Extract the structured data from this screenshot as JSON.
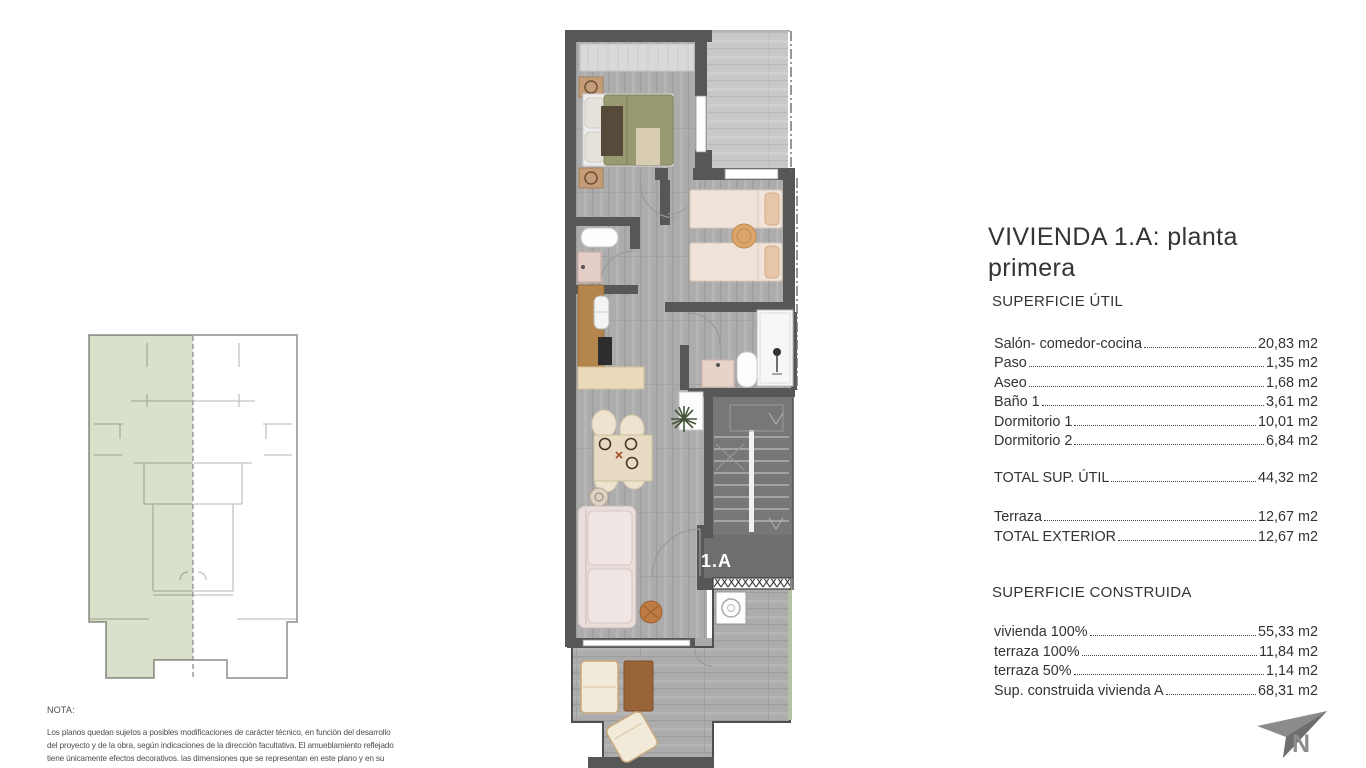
{
  "title": "VIVIENDA 1.A: planta primera",
  "plan": {
    "unit_label": "1.A"
  },
  "compass": {
    "label": "N"
  },
  "sections": {
    "util": {
      "heading": "SUPERFICIE ÚTIL",
      "rows": [
        {
          "label": "Salón- comedor-cocina",
          "value": "20,83 m2"
        },
        {
          "label": "Paso",
          "value": "1,35 m2"
        },
        {
          "label": "Aseo",
          "value": "1,68 m2"
        },
        {
          "label": "Baño 1",
          "value": "3,61 m2"
        },
        {
          "label": "Dormitorio 1",
          "value": "10,01 m2"
        },
        {
          "label": "Dormitorio 2",
          "value": "6,84 m2"
        }
      ],
      "total": {
        "label": "TOTAL SUP. ÚTIL",
        "value": "44,32 m2"
      }
    },
    "exterior": {
      "rows": [
        {
          "label": "Terraza",
          "value": "12,67 m2"
        }
      ],
      "total": {
        "label": "TOTAL EXTERIOR",
        "value": "12,67 m2"
      }
    },
    "construida": {
      "heading": "SUPERFICIE CONSTRUIDA",
      "rows": [
        {
          "label": "vivienda 100% ",
          "value": "55,33 m2"
        },
        {
          "label": "terraza 100%",
          "value": "11,84 m2"
        },
        {
          "label": "terraza 50%",
          "value": "1,14 m2"
        },
        {
          "label": "Sup. construida vivienda A",
          "value": "68,31 m2"
        }
      ]
    }
  },
  "note": {
    "heading": "NOTA:",
    "lines": [
      "Los planos quedan sujetos a posibles modificaciones de carácter técnico, en función del desarrollo",
      "del proyecto y de la obra, según indicaciones de la dirección facultativa. El amueblamiento reflejado",
      "tiene únicamente efectos decorativos. las dimensiones que se representan en este plano y en su"
    ]
  },
  "colors": {
    "wall": "#575757",
    "floor": "#ababab",
    "terrace_floor": "#c7c7c7",
    "stair": "#777777",
    "highlight_green": "#d6dec6",
    "bed_olive": "#9a9a72",
    "bed_cream": "#f0e4da",
    "kitchen_wood": "#b5854e",
    "pouf_orange": "#bd7a42",
    "glass_green": "#b2c3a4"
  }
}
